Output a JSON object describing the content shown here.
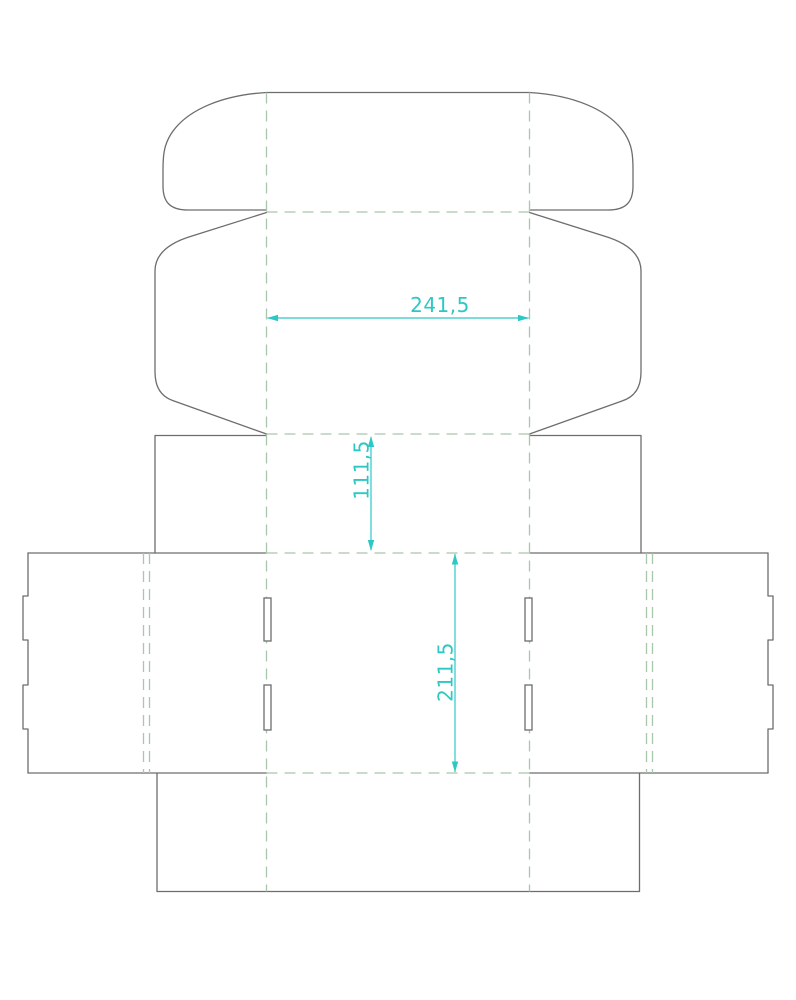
{
  "diagram": {
    "kind": "packaging-dieline",
    "dimensions": [
      {
        "id": "width",
        "label": "241,5",
        "orientation": "horizontal"
      },
      {
        "id": "depth",
        "label": "111,5",
        "orientation": "vertical"
      },
      {
        "id": "length",
        "label": "211,5",
        "orientation": "vertical"
      }
    ],
    "colors": {
      "background": "#ffffff",
      "cut_line": "#6d6d6d",
      "fold_line": "#a9c7ad",
      "dimension": "#2cc8c4"
    }
  }
}
